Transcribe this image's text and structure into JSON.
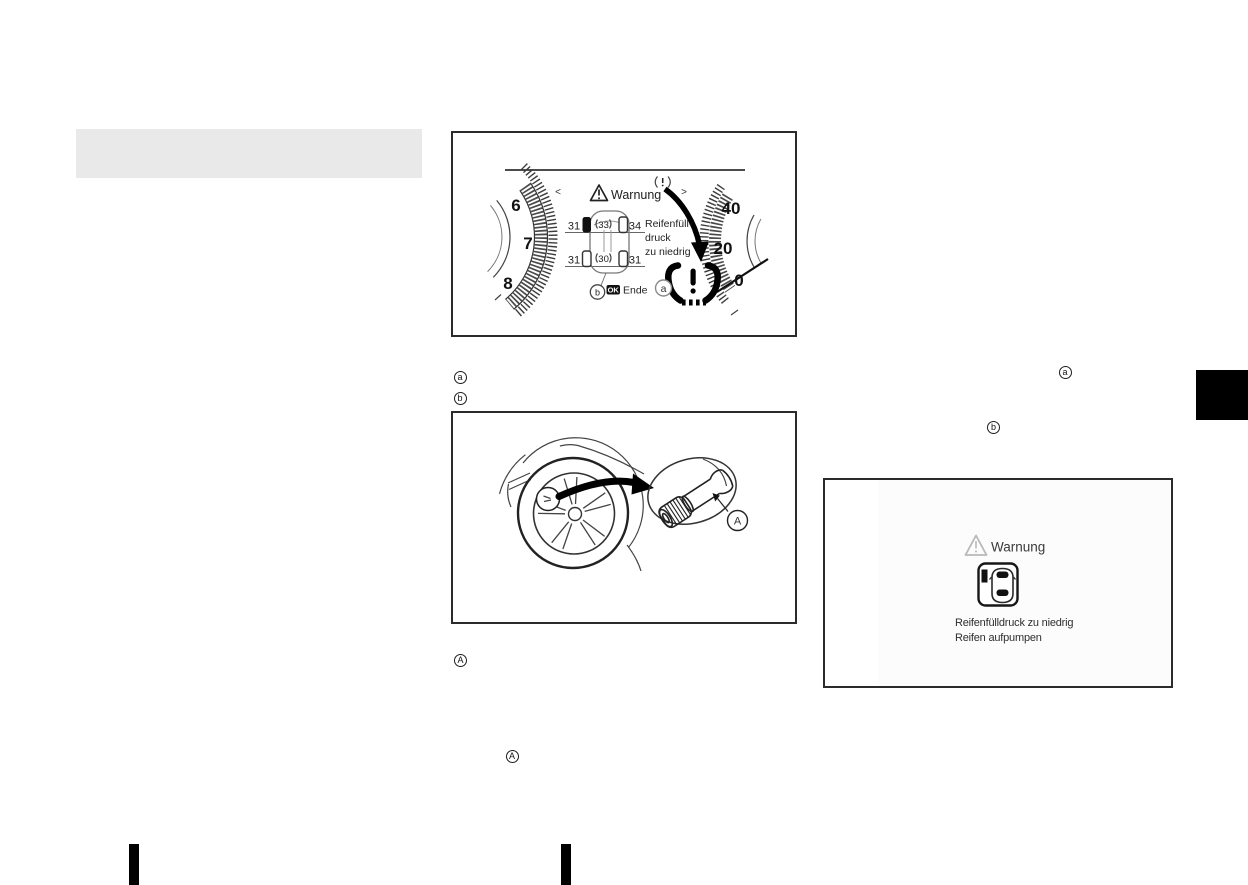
{
  "colors": {
    "heading_bar": "#e9e9e9",
    "figure_border": "#2b2b2b",
    "ink": "#1c1c1c",
    "warning_gray": "#b8b8b8"
  },
  "icons": {
    "tpms_warning_lamp_icon": "(!)",
    "tpms_mini_icon": "(!)",
    "warning_triangle_icon": "⚠",
    "chevron_left_icon": "<",
    "chevron_right_icon": ">",
    "pointer_arrow_icon": "⬇",
    "car_top_view_icon": "car outline"
  },
  "figure_cluster": {
    "warning_title": "Warnung",
    "chevron_left": "<",
    "chevron_right": ">",
    "tachometer_labels": [
      "6",
      "7",
      "8"
    ],
    "speedometer_labels": [
      "40",
      "20",
      "0"
    ],
    "tire_pressures": {
      "front_left": "31",
      "front_center": "33",
      "front_right": "34",
      "rear_left": "31",
      "rear_center": "30",
      "rear_right": "31"
    },
    "message_lines": [
      "Reifenfüll-",
      "druck",
      "zu niedrig"
    ],
    "ok_button": "OK",
    "end_label": "Ende",
    "callout_a": "a",
    "callout_b": "b"
  },
  "callout_list": {
    "item_a": "a",
    "item_b": "b"
  },
  "figure_wheel": {
    "callout_A": "A"
  },
  "body_refs": {
    "ref_A_first": "A",
    "ref_A_second": "A",
    "ref_a_right": "a",
    "ref_b_right": "b"
  },
  "figure_display": {
    "title": "Warnung",
    "message_line1": "Reifenfülldruck zu niedrig",
    "message_line2": "Reifen aufpumpen"
  }
}
